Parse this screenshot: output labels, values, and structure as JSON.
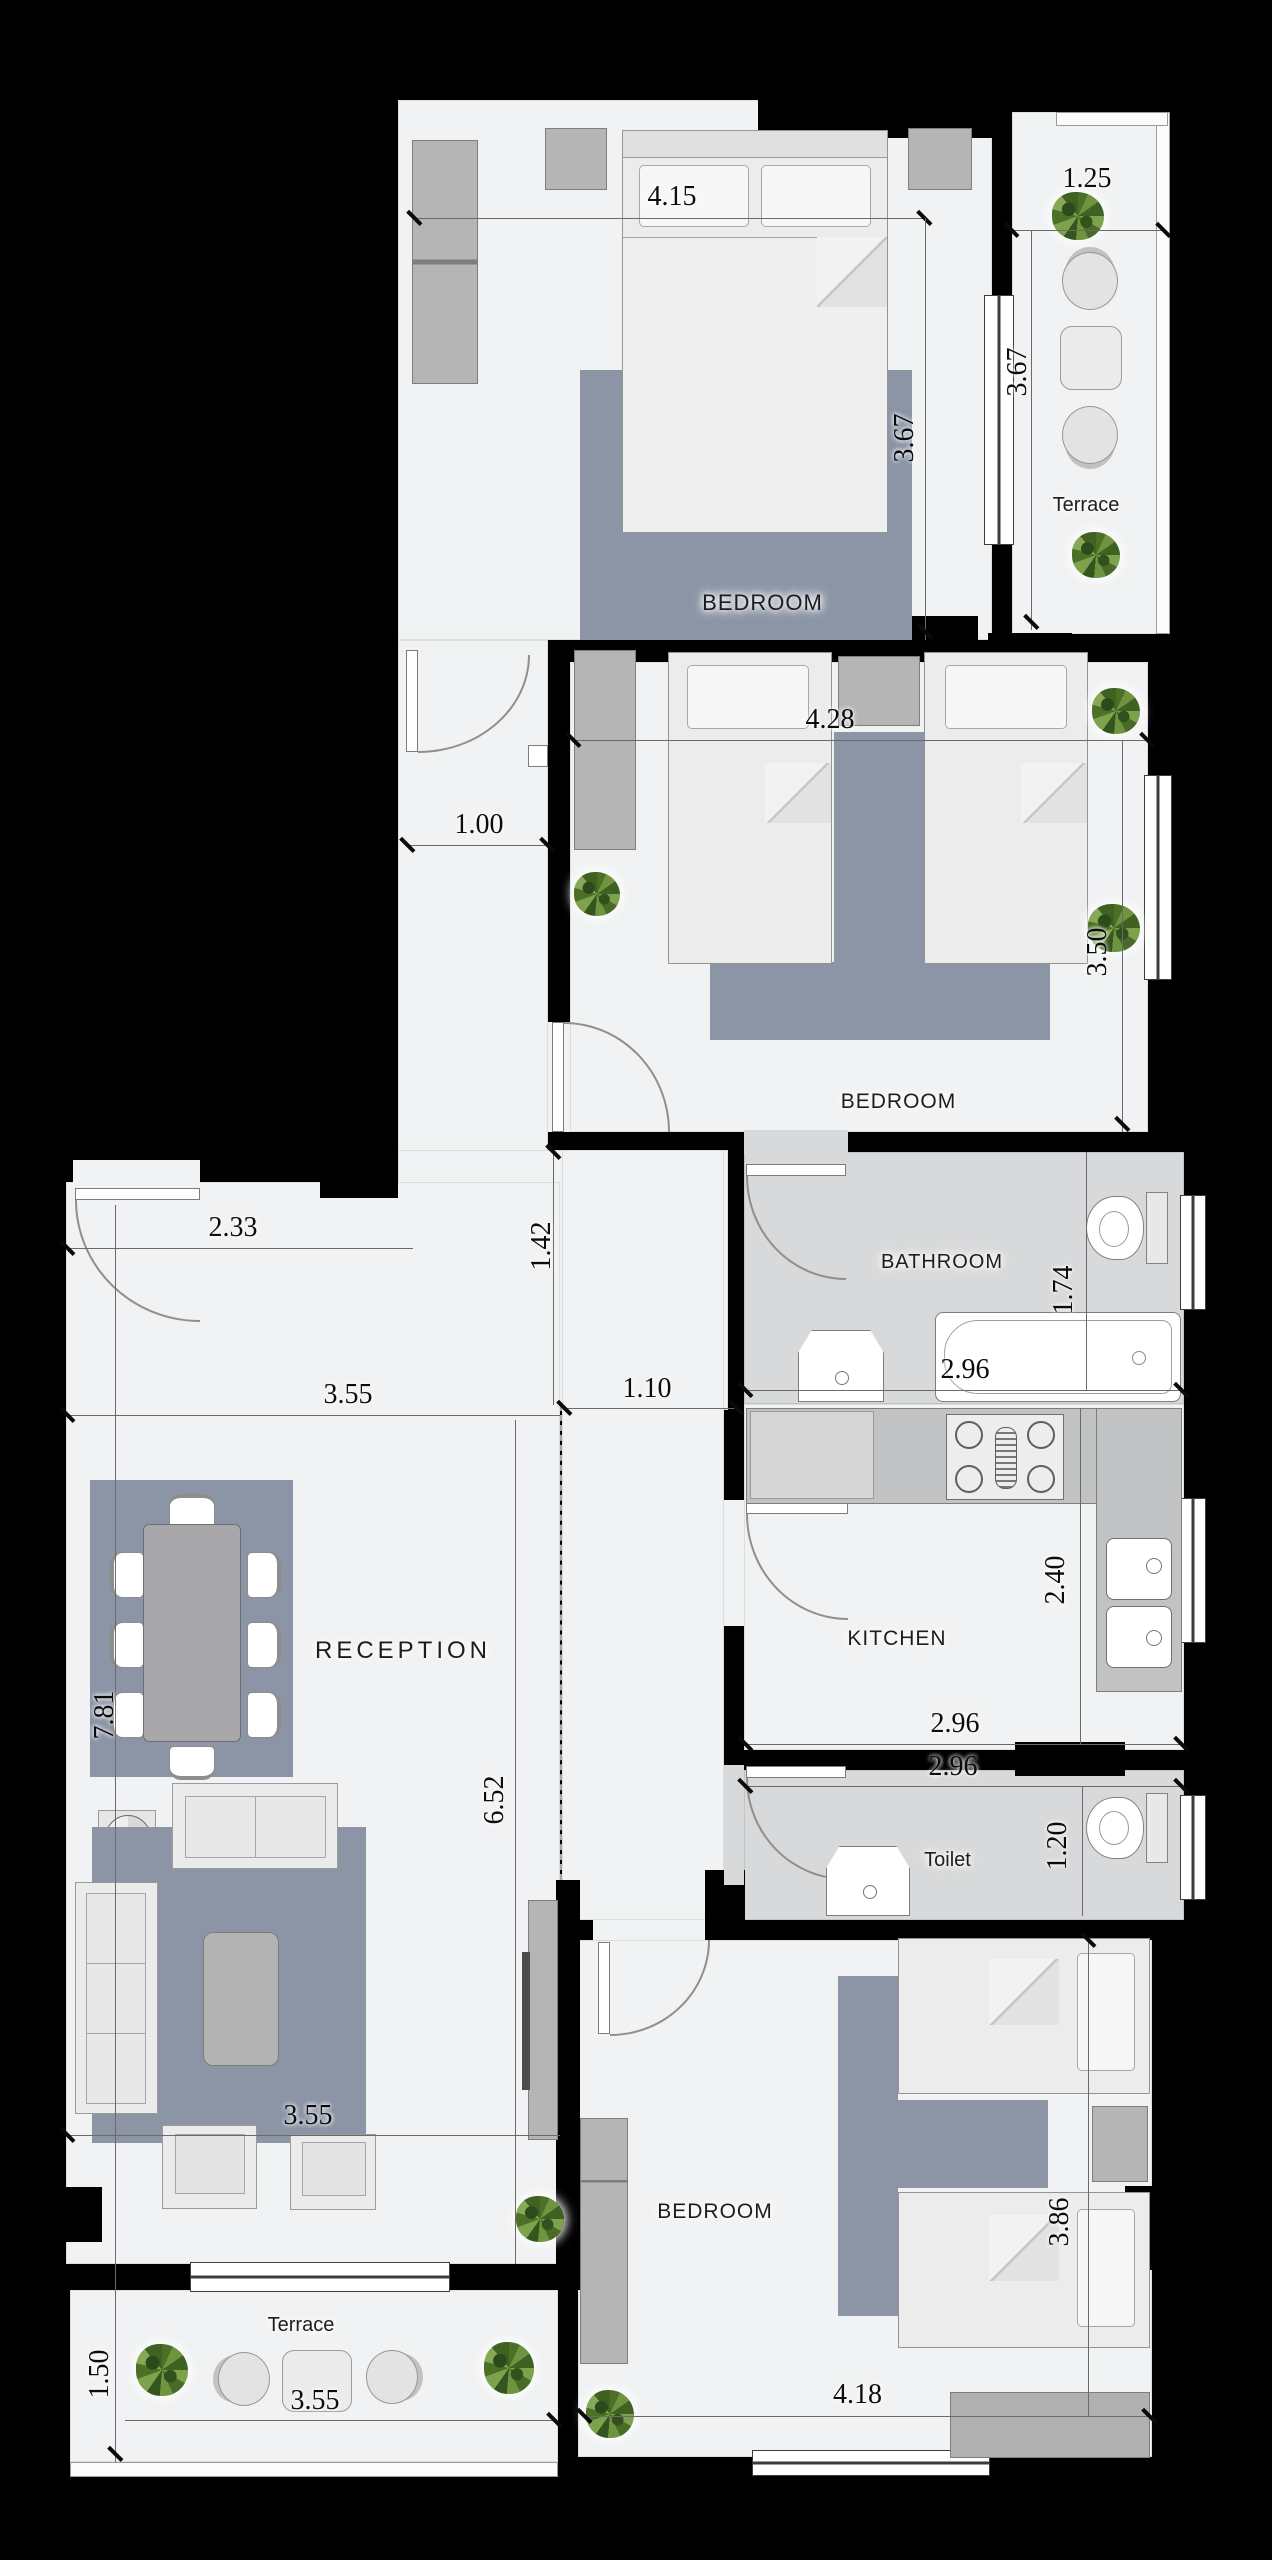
{
  "plan": {
    "type": "apartment-floor-plan",
    "units": "meters",
    "colors": {
      "background": "#000000",
      "floor": "#f1f2f3",
      "wet_room_floor": "#d8d9da",
      "rug": "#8c95a6",
      "cabinet": "#b5b5b6",
      "plant": "#6f9440"
    }
  },
  "rooms": {
    "bedroom_top": {
      "label": "BEDROOM",
      "width": "4.15",
      "height": "3.67"
    },
    "terrace_top": {
      "label": "Terrace",
      "width": "1.25",
      "height": "3.67"
    },
    "bedroom_middle": {
      "label": "BEDROOM",
      "width": "4.28",
      "height": "3.50"
    },
    "bathroom": {
      "label": "BATHROOM",
      "width": "2.96",
      "height": "1.74"
    },
    "kitchen": {
      "label": "KITCHEN",
      "width": "2.96",
      "height": "2.40"
    },
    "toilet": {
      "label": "Toilet",
      "width": "2.96",
      "height": "1.20"
    },
    "reception": {
      "label": "RECEPTION",
      "width": "3.55",
      "bottom_width": "3.55",
      "height": "7.81",
      "inner_height": "6.52",
      "entry_width": "2.33"
    },
    "bedroom_bottom": {
      "label": "BEDROOM",
      "width": "4.18",
      "height": "3.86"
    },
    "terrace_bottom": {
      "label": "Terrace",
      "width": "3.55",
      "height": "1.50"
    },
    "hallway": {
      "width": "1.00",
      "passage": "1.42",
      "corridor": "1.10"
    }
  }
}
